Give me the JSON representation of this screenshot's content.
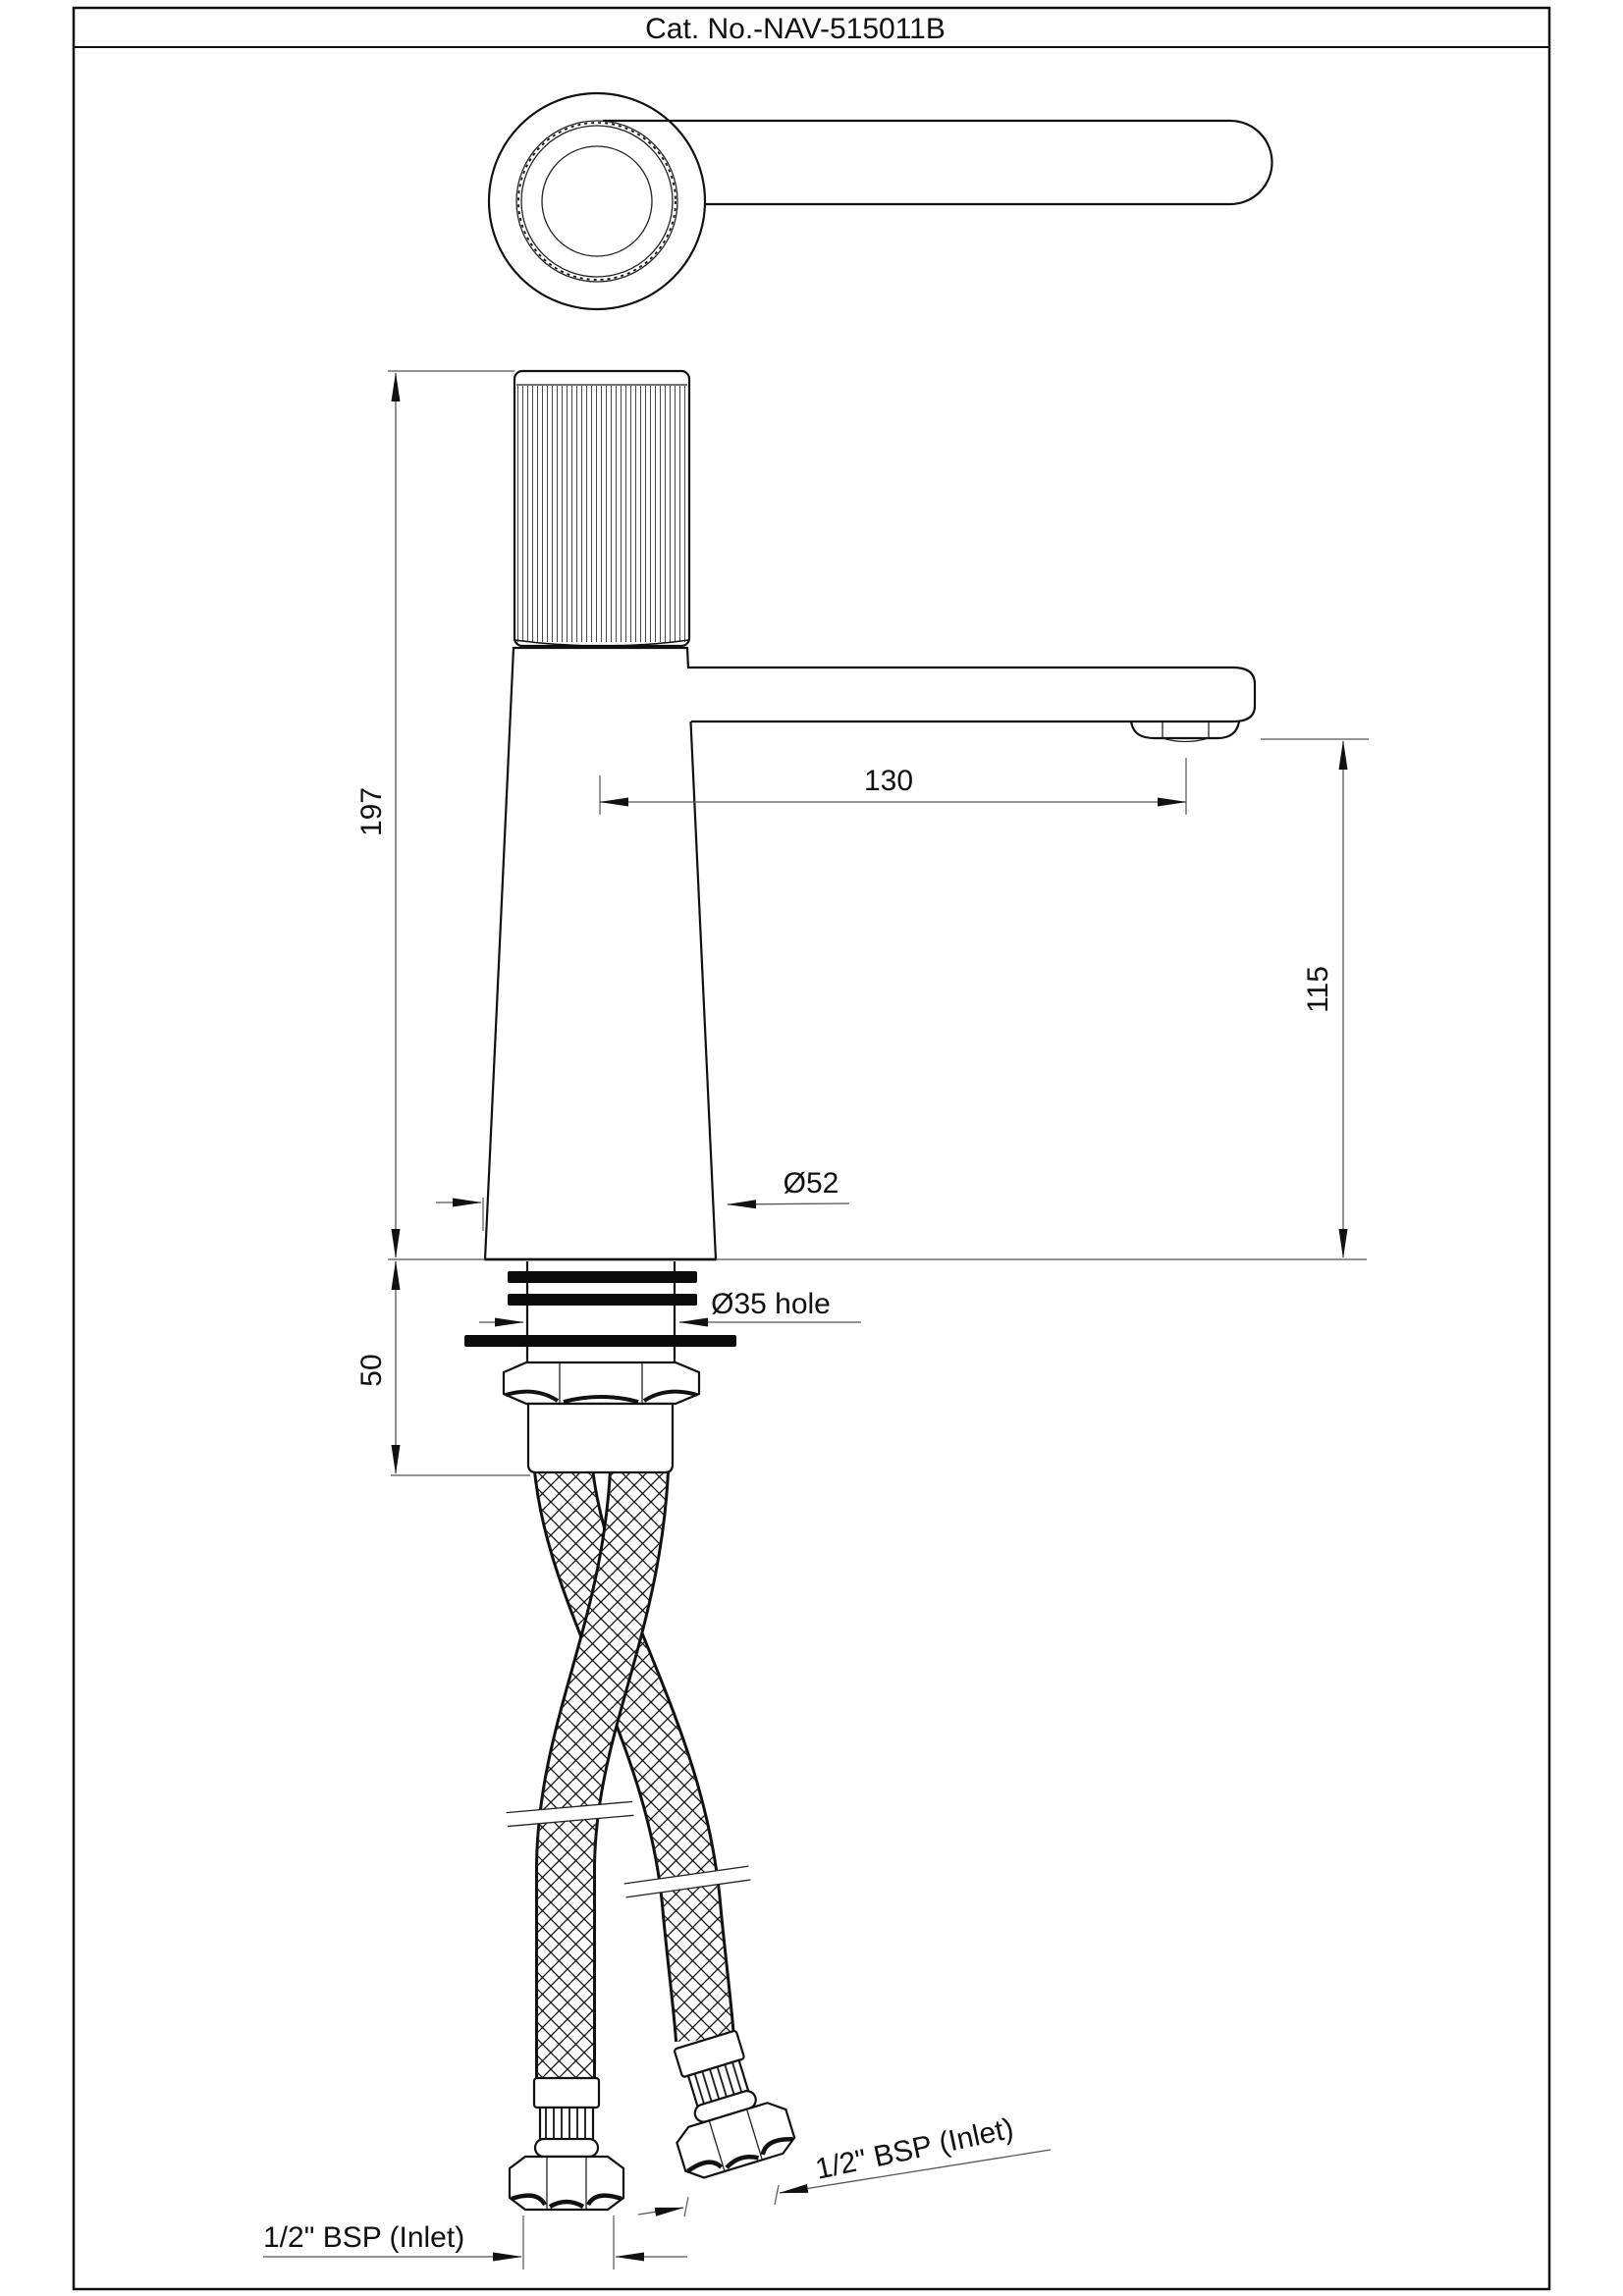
{
  "title": "Cat. No.-NAV-515011B",
  "drawing": {
    "type": "technical-dimension-drawing",
    "product": "single-lever basin mixer faucet",
    "views": [
      "handle-top-view",
      "front-elevation-with-supply-hoses"
    ],
    "dimensions": {
      "total_height": "197",
      "spout_reach": "130",
      "spout_height": "115",
      "base_diameter": "Ø52",
      "mounting_hole": "Ø35 hole",
      "shank_length": "50",
      "inlet_left": "1/2\" BSP (Inlet)",
      "inlet_right": "1/2\" BSP (Inlet)"
    }
  }
}
